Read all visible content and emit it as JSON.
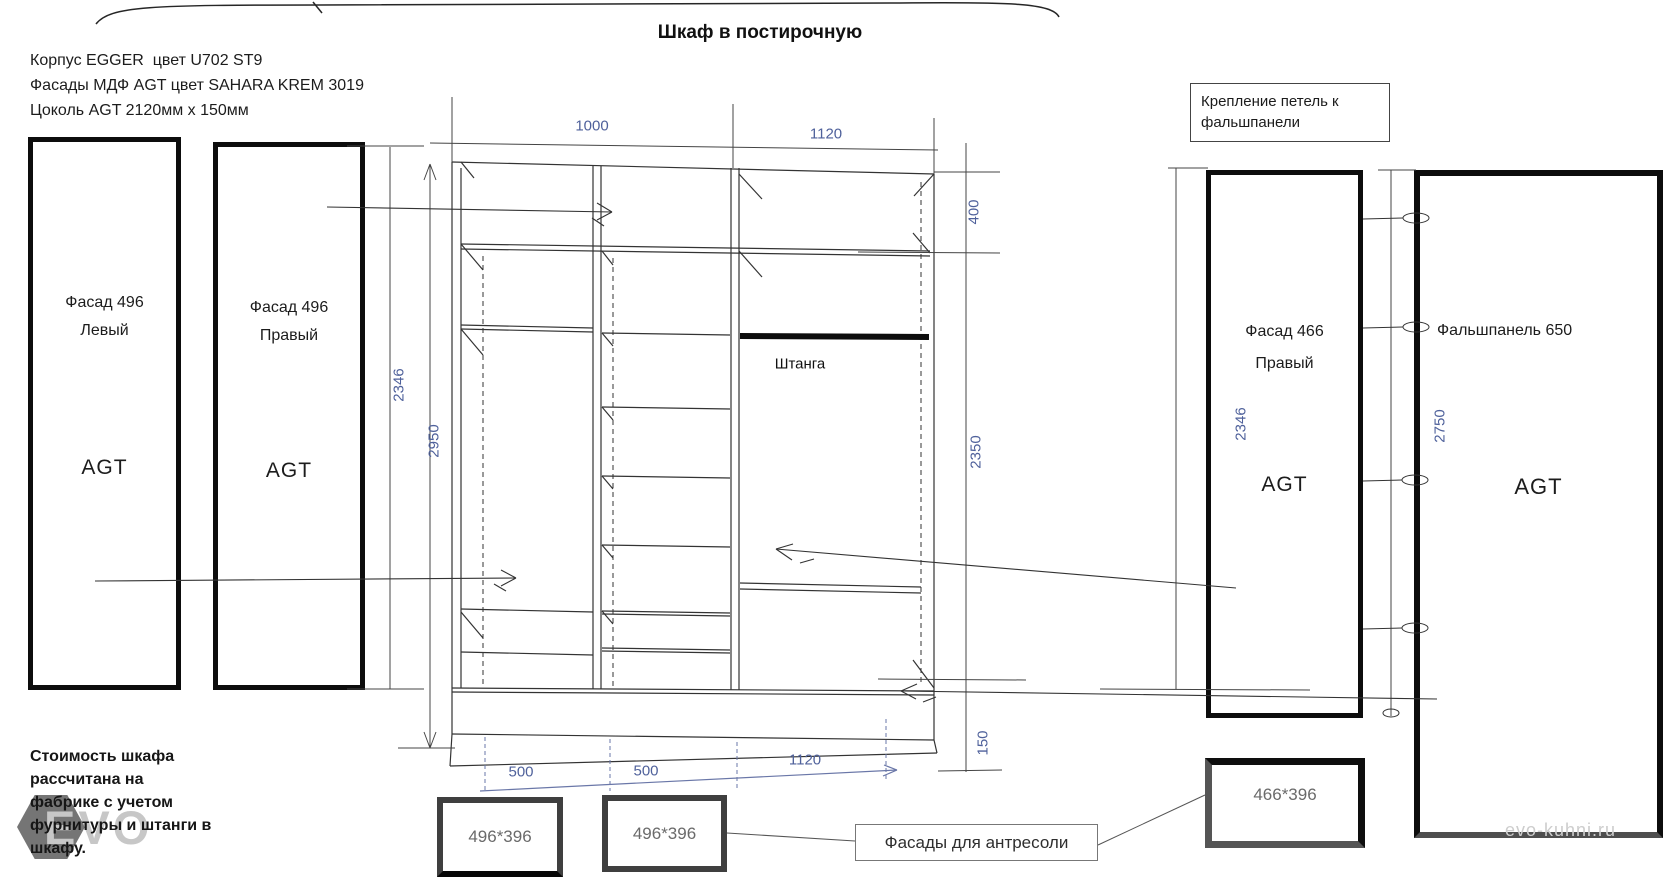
{
  "title": "Шкаф в постирочную",
  "specs": {
    "line1": "Корпус EGGER  цвет U702 ST9",
    "line2": "Фасады МДФ AGT цвет SAHARA KREM 3019",
    "line3": "Цоколь AGT 2120мм x 150мм"
  },
  "panels": {
    "facade_left": {
      "title": "Фасад 496",
      "side": "Левый",
      "brand": "AGT"
    },
    "facade_right": {
      "title": "Фасад 496",
      "side": "Правый",
      "brand": "AGT"
    },
    "facade_466": {
      "title": "Фасад 466",
      "side": "Правый",
      "brand": "AGT",
      "height_dim": "2346"
    },
    "false_panel": {
      "title": "Фальшпанель 650",
      "brand": "AGT",
      "height_dim": "2750"
    }
  },
  "wardrobe": {
    "rod_label": "Штанга",
    "dim_width_left": "1000",
    "dim_width_right": "1120",
    "dim_height_outer": "2346",
    "dim_height_inner": "2950",
    "dim_mezzanine": "400",
    "dim_interior": "2350",
    "dim_plinth": "150",
    "dim_bottom_1": "500",
    "dim_bottom_2": "500",
    "dim_bottom_3": "1120"
  },
  "callouts": {
    "hinge_note_line1": "Крепление петель к",
    "hinge_note_line2": "фальшпанели",
    "mezzanine_facades": "Фасады для антресоли"
  },
  "mezzanine_sizes": {
    "box1": "496*396",
    "box2": "496*396",
    "box3": "466*396"
  },
  "note_lines": [
    "Стоимость шкафа",
    "рассчитана на",
    "фабрике с учетом",
    "фурнитуры и штанги в",
    "шкафу."
  ],
  "watermark": {
    "logo": "EVO",
    "site": "evo-kuhni.ru"
  },
  "colors": {
    "dim_text": "#4f619b",
    "line": "#333333",
    "panel_border": "#0d0d0d"
  }
}
